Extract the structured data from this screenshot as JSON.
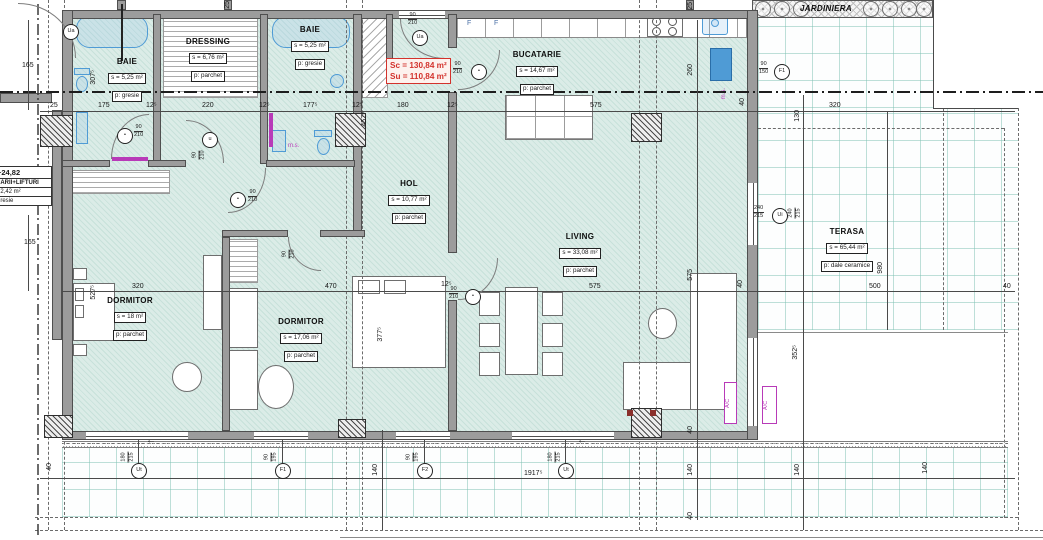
{
  "colors": {
    "wall_gray": "#9c9c9c",
    "floor_mint": "#dbece7",
    "grid_teal": "#7dc0b2",
    "accent_red": "#d3322c",
    "magenta": "#b83ab8",
    "fixture_blue": "#4f9bd5"
  },
  "rooms": [
    {
      "name": "BAIE",
      "area": "s = 5,25 m²",
      "floor": "p: gresie"
    },
    {
      "name": "DRESSING",
      "area": "s = 6,76 m²",
      "floor": "p: parchet"
    },
    {
      "name": "BAIE",
      "area": "s = 5,25 m²",
      "floor": "p: gresie"
    },
    {
      "name": "BUCATARIE",
      "area": "s = 14,67 m²",
      "floor": "p: parchet"
    },
    {
      "name": "HOL",
      "area": "s = 10,77 m²",
      "floor": "p: parchet"
    },
    {
      "name": "LIVING",
      "area": "s = 33,08 m²",
      "floor": "p: parchet"
    },
    {
      "name": "DORMITOR",
      "area": "s = 18 m²",
      "floor": "p: parchet"
    },
    {
      "name": "DORMITOR",
      "area": "s = 17,06 m²",
      "floor": "p: parchet"
    },
    {
      "name": "TERASA",
      "area": "s = 65,44 m²",
      "floor": "p: dale ceramice"
    },
    {
      "name": "JARDINIERA"
    }
  ],
  "stair_block": {
    "elevation": "+24,82",
    "title": "CARII+LIFTURI",
    "area": "32,42 m²",
    "floor": "gresie"
  },
  "area_summary": {
    "sc": "Sc = 130,84 m²",
    "su": "Su = 110,84 m²"
  },
  "kitchen": {
    "cabinet_letter_1": "F",
    "cabinet_letter_2": "F",
    "ms_label": "m.s."
  },
  "bath2": {
    "ms_label": "m.s."
  },
  "hvac": {
    "ac_label_1": "A/C",
    "ac_label_2": "A/C"
  },
  "arrows": {
    "left_1": "←",
    "left_2": "←"
  },
  "openings": {
    "ua_left": {
      "label": "Ua"
    },
    "ua_entry": {
      "label": "Ua",
      "w": "90",
      "h": "210"
    },
    "kitchen_door": {
      "w": "90",
      "h": "210"
    },
    "baie1_door": {
      "w": "90",
      "h": "210"
    },
    "dressing_door": {
      "label": "u",
      "w": "90",
      "h": "210"
    },
    "baie2_door": {
      "w": "90",
      "h": "210"
    },
    "dorm2_door": {
      "w": "90",
      "h": "210"
    },
    "living_door": {
      "w": "90",
      "h": "210"
    },
    "terasa_door": {
      "label": "Ui",
      "w": "240",
      "h": "215"
    },
    "terasa_window": {
      "label": "F1",
      "w": "90",
      "h": "150"
    },
    "win_dorm1": {
      "label": "Ut",
      "w": "180",
      "h": "215"
    },
    "win_dorm2": {
      "label": "F1",
      "w": "90",
      "h": "195"
    },
    "win_hol": {
      "label": "F2",
      "w": "90",
      "h": "195"
    },
    "door_living_terasa": {
      "label": "Ut",
      "w": "180",
      "h": "215"
    }
  },
  "dims": [
    "165",
    "165",
    "25",
    "175",
    "12⁵",
    "220",
    "12⁵",
    "177⁵",
    "12⁵",
    "180",
    "12⁵",
    "575",
    "40",
    "320",
    "25",
    "25",
    "307⁵",
    "457⁵",
    "260",
    "130",
    "527⁵",
    "320",
    "470",
    "575",
    "12⁵",
    "575",
    "377⁵",
    "352⁵",
    "980",
    "500",
    "40",
    "40",
    "1917⁵",
    "140",
    "140",
    "140",
    "140",
    "40",
    "40",
    "40"
  ]
}
